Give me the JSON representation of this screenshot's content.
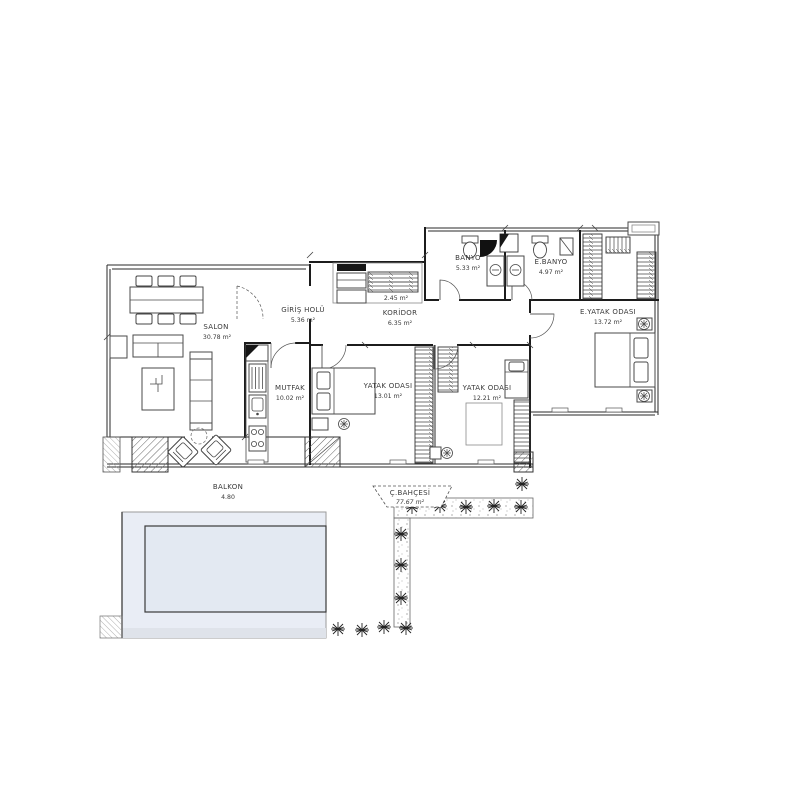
{
  "page": {
    "background": "#ffffff",
    "ink": "#1c1c1c",
    "pool_fill": "#e9edf5",
    "pool_inner_fill": "#e3e9f2"
  },
  "rooms": [
    {
      "id": "salon",
      "name": "SALON",
      "area": "30.78 m²"
    },
    {
      "id": "giris-holu",
      "name": "GİRİŞ HOLÜ",
      "area": "5.36 m²"
    },
    {
      "id": "koridor",
      "name": "KORİDOR",
      "area": "6.35 m²"
    },
    {
      "id": "vestiyer",
      "name": "",
      "area": "2.45 m²"
    },
    {
      "id": "banyo",
      "name": "BANYO",
      "area": "5.33 m²"
    },
    {
      "id": "e-banyo",
      "name": "E.BANYO",
      "area": "4.97 m²"
    },
    {
      "id": "e-yatak-odasi",
      "name": "E.YATAK ODASI",
      "area": "13.72 m²"
    },
    {
      "id": "mutfak",
      "name": "MUTFAK",
      "area": "10.02 m²"
    },
    {
      "id": "yatak-odasi-1",
      "name": "YATAK ODASI",
      "area": "13.01 m²"
    },
    {
      "id": "yatak-odasi-2",
      "name": "YATAK ODASI",
      "area": "12.21 m²"
    },
    {
      "id": "balkon",
      "name": "BALKON",
      "area": "4.80"
    },
    {
      "id": "cati-bahcesi",
      "name": "Ç.BAHÇESİ",
      "area": "77.67 m²"
    }
  ]
}
